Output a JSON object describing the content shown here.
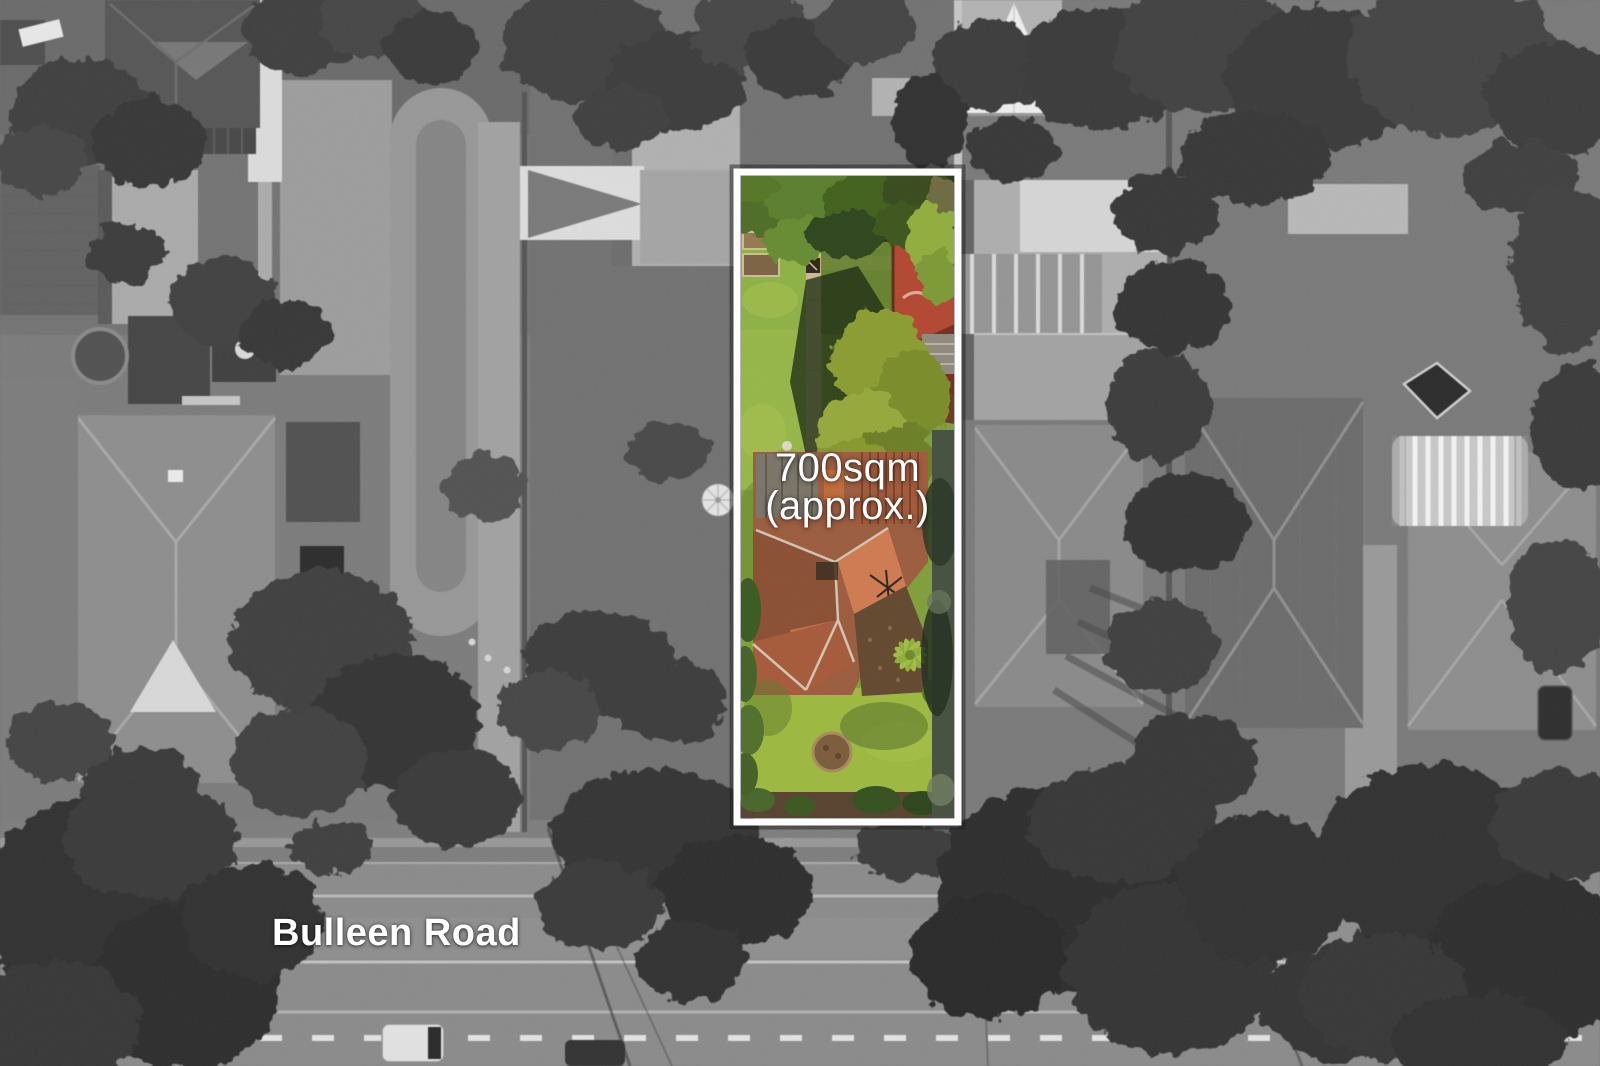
{
  "annotations": {
    "lot_area_line1": "700sqm",
    "lot_area_line2": "(approx.)",
    "road_name": "Bulleen Road"
  },
  "colors": {
    "lot_border": "#ffffff",
    "label_text": "#ffffff",
    "lot_lawn_green": "#8db145",
    "lot_roof_terracotta": "#9b5c3e",
    "red_court": "#b24731",
    "surroundings_gray": "#8b8b8b"
  }
}
